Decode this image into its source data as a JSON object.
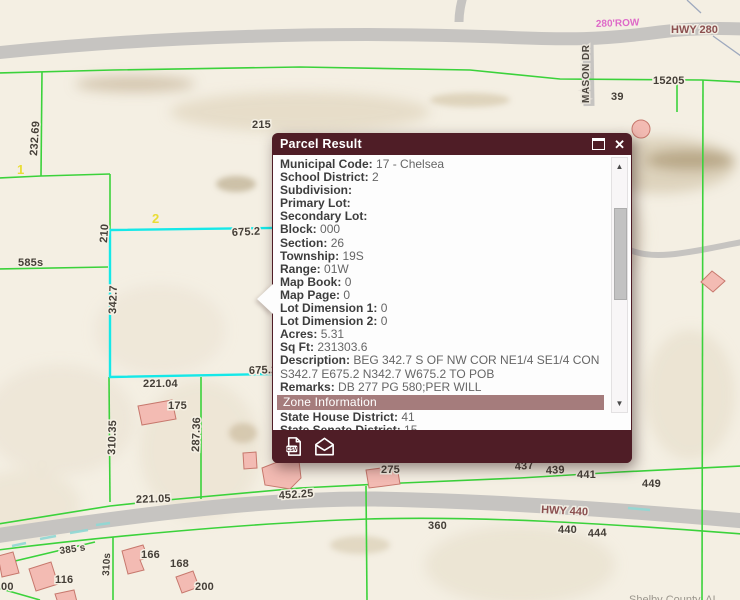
{
  "app": {
    "attribution": "Shelby County, AL"
  },
  "map": {
    "colors": {
      "background": "#f4efe3",
      "parcel_line": "#3bd23b",
      "selected_parcel": "#15e8e8",
      "road": "#c6c4c1",
      "building_fill": "#f3bbb3",
      "building_stroke": "#c7786d",
      "highway_label": "#8b4f4f",
      "row_label": "#de6ac8",
      "lot_label_yellow": "#e9dd35"
    },
    "road_labels": [
      {
        "text": "HWY 280"
      },
      {
        "text": "HWY 440"
      },
      {
        "text": "MASON DR"
      },
      {
        "text": "280'ROW"
      }
    ],
    "yellow_lot_labels": [
      {
        "text": "1"
      },
      {
        "text": "2"
      }
    ],
    "labels": [
      {
        "text": "232.69"
      },
      {
        "text": "215"
      },
      {
        "text": "210"
      },
      {
        "text": "585s"
      },
      {
        "text": "675.2"
      },
      {
        "text": "342.7"
      },
      {
        "text": "675.2"
      },
      {
        "text": "221.04"
      },
      {
        "text": "175"
      },
      {
        "text": "310.35"
      },
      {
        "text": "287.36"
      },
      {
        "text": "221.05"
      },
      {
        "text": "452.25"
      },
      {
        "text": "275"
      },
      {
        "text": "437"
      },
      {
        "text": "439"
      },
      {
        "text": "441"
      },
      {
        "text": "449"
      },
      {
        "text": "360"
      },
      {
        "text": "440"
      },
      {
        "text": "444"
      },
      {
        "text": "15205"
      },
      {
        "text": "39"
      },
      {
        "text": "385 s"
      },
      {
        "text": "310s"
      },
      {
        "text": "166"
      },
      {
        "text": "168"
      },
      {
        "text": "116"
      },
      {
        "text": "200"
      },
      {
        "text": "00"
      }
    ]
  },
  "popup": {
    "title": "Parcel Result",
    "controls": {
      "close_glyph": "✕"
    },
    "fields": [
      {
        "label": "Municipal Code:",
        "value": "17 - Chelsea"
      },
      {
        "label": "School District:",
        "value": "2"
      },
      {
        "label": "Subdivision:",
        "value": ""
      },
      {
        "label": "Primary Lot:",
        "value": ""
      },
      {
        "label": "Secondary Lot:",
        "value": ""
      },
      {
        "label": "Block:",
        "value": "000"
      },
      {
        "label": "Section:",
        "value": "26"
      },
      {
        "label": "Township:",
        "value": "19S"
      },
      {
        "label": "Range:",
        "value": "01W"
      },
      {
        "label": "Map Book:",
        "value": "0"
      },
      {
        "label": "Map Page:",
        "value": "0"
      },
      {
        "label": "Lot Dimension 1:",
        "value": "0"
      },
      {
        "label": "Lot Dimension 2:",
        "value": "0"
      },
      {
        "label": "Acres:",
        "value": "5.31"
      },
      {
        "label": "Sq Ft:",
        "value": "231303.6"
      },
      {
        "label": "Description:",
        "value": "BEG 342.7 S OF NW COR NE1/4 SE1/4 CON S342.7 E675.2 N342.7 W675.2 TO POB"
      },
      {
        "label": "Remarks:",
        "value": "DB 277 PG 580;PER WILL"
      }
    ],
    "zone_section": {
      "header": "Zone Information",
      "fields": [
        {
          "label": "State House District:",
          "value": "41"
        },
        {
          "label": "State Senate District:",
          "value": "15"
        }
      ]
    },
    "scrollbar": {
      "up_glyph": "▲",
      "down_glyph": "▼"
    }
  }
}
